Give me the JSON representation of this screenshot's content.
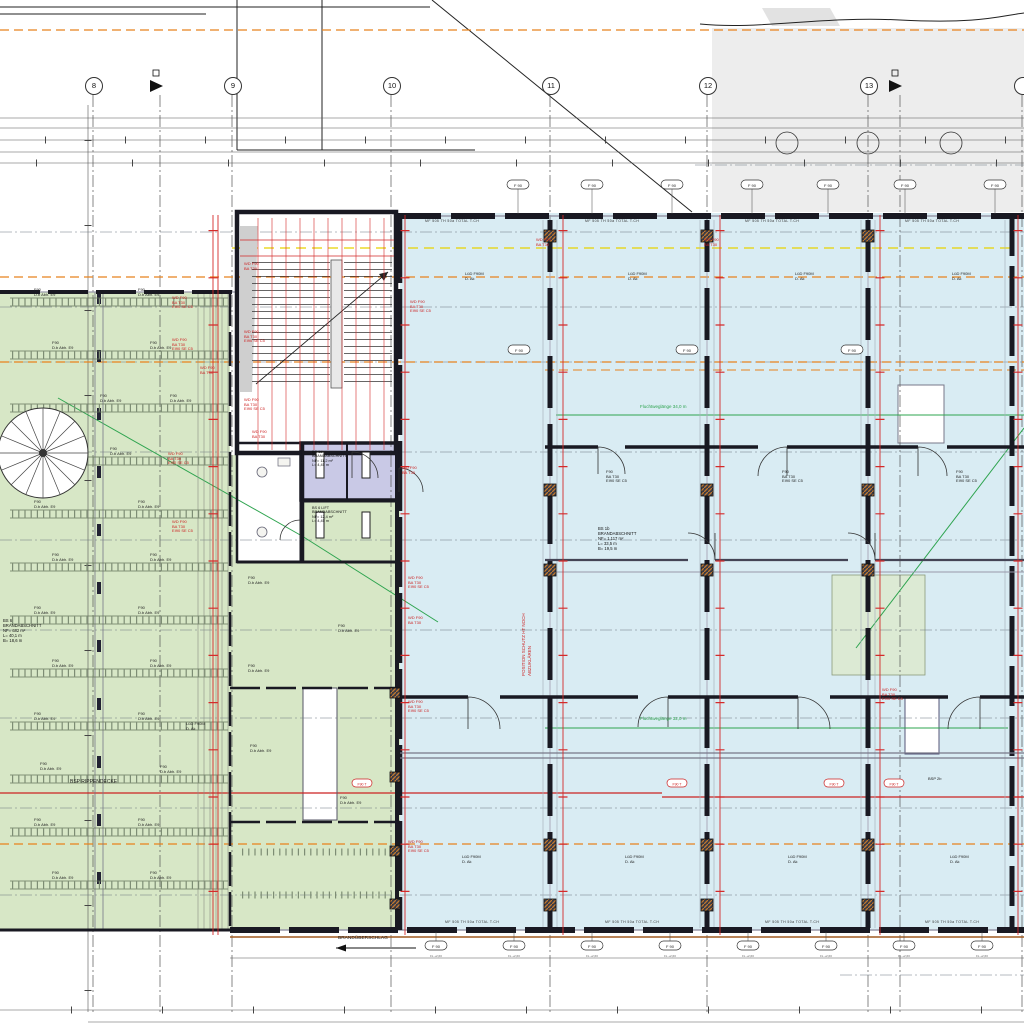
{
  "grid": {
    "labels": [
      "8",
      "9",
      "10",
      "11",
      "12",
      "13"
    ]
  },
  "rooms": {
    "left": {
      "l1": "BS 6",
      "l2": "BRANDABSCHNITT",
      "l3": "NF= 682 m²",
      "l4": "L= 40,1 m",
      "l5": "B= 18,6 m"
    },
    "center": {
      "l1": "BS 1b",
      "l2": "BRANDABSCHNITT",
      "l3": "NF= 1.117 m²",
      "l4": "L= 33,5 m",
      "l5": "B= 19,5 m"
    },
    "shaft": {
      "l1": "BS 1d",
      "l2": "BRANDABSCHNITT",
      "l3": "NF= 11,2 m²",
      "l4": "L= 4,45 m",
      "l5": "B= 2,60 m"
    },
    "lift": {
      "l1": "BS 6 LIFT",
      "l2": "BRANDABSCHNITT",
      "l3": "NF= 12,4 m²",
      "l4": "L= 4,45 m",
      "l5": "B= 2,80 m"
    }
  },
  "notes": {
    "rippendecke": "BSP RIPPENDECKE",
    "bsp2b": "BSP 2b",
    "brandueberschlag": "BRANDÜBERSCHLAG",
    "flucht1": "Fluchtweglänge  34,0 m",
    "flucht2": "Fluchtweglänge  32,0 m",
    "rot1": "POSITION SCHUTZ HT NOCH",
    "rot2": "ABZUKLÄREN"
  },
  "badge": {
    "label": "F 90",
    "sub": "FL +2,60",
    "red": "F90 T"
  },
  "callouts": {
    "f90_1": "F90",
    "f90_2": "D.b Abh. E9",
    "lued_1": "LüD F90M",
    "lued_2": "D. Ak",
    "red_1": "WD F90",
    "red_2": "BA T30",
    "red_3": "EI90 SE C5",
    "blk_1": "F90",
    "blk_2": "BA T30",
    "blk_3": "EI90 SE C5"
  },
  "wall_tag": "MF 505  TH 50a  TOTAL  T.CH",
  "colors": {
    "green_plate": "#d7e7c6",
    "blue_plate": "#d9ecf3",
    "shaft_purple": "#c9c9e6",
    "neighbor_gray": "#ededed",
    "annotation_red": "#d42a2a",
    "line_orange": "#e8821e",
    "line_yellow": "#e8d200",
    "line_green": "#2ea44f",
    "wall_dark": "#191922"
  }
}
